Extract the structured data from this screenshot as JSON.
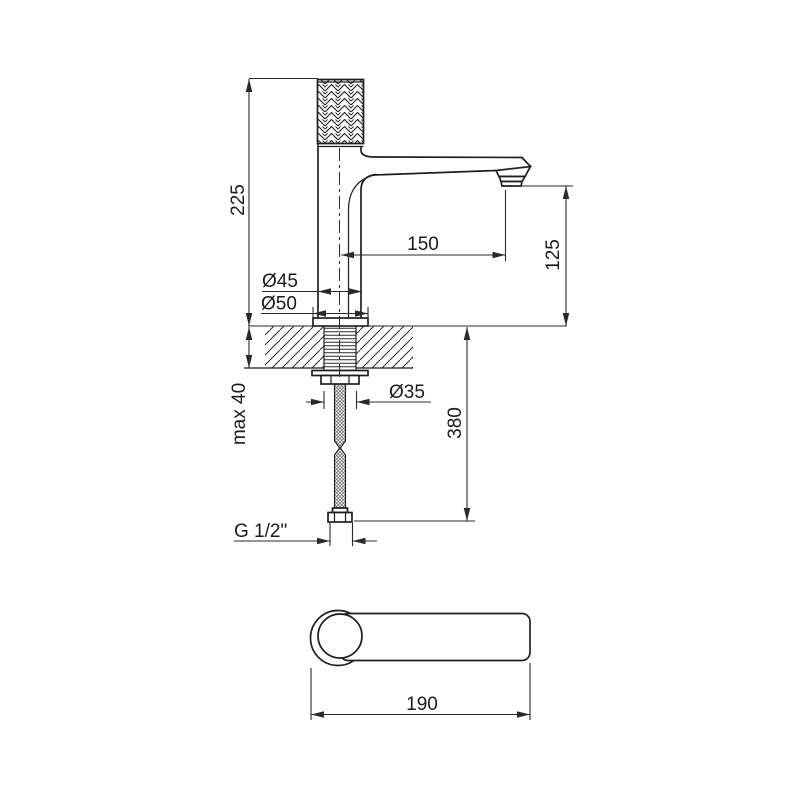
{
  "drawing": {
    "dimensions": {
      "total_height": "225",
      "spout_reach": "150",
      "outlet_height": "125",
      "body_diameter": "Ø45",
      "base_diameter": "Ø50",
      "hole_diameter": "Ø35",
      "deck_thickness": "max 40",
      "hose_length": "380",
      "connection_thread": "G 1/2\"",
      "top_view_length": "190"
    }
  }
}
